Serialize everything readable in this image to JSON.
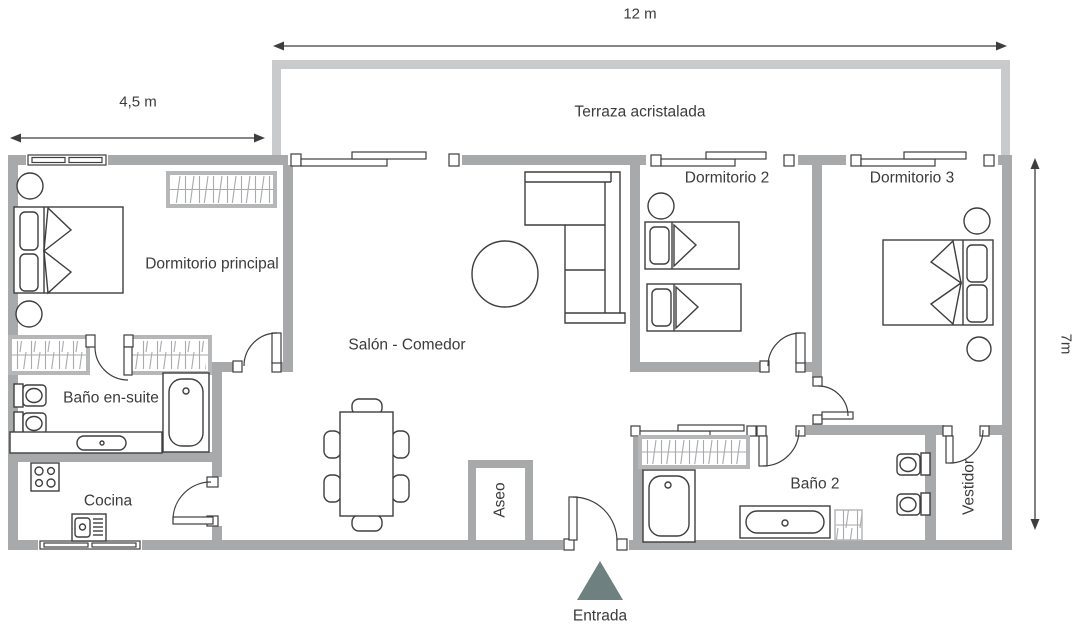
{
  "dimensions": {
    "top": "12 m",
    "left": "4,5 m",
    "right": "7m"
  },
  "rooms": {
    "terrace": "Terraza acristalada",
    "master_bedroom": "Dormitorio principal",
    "bedroom_2": "Dormitorio 2",
    "bedroom_3": "Dormitorio 3",
    "living_dining": "Salón - Comedor",
    "ensuite_bathroom": "Baño en-suite",
    "kitchen": "Cocina",
    "toilet": "Aseo",
    "bathroom_2": "Baño 2",
    "dressing_room": "Vestidor"
  },
  "entrance_label": "Entrada",
  "colors": {
    "wall": "#a7a9aa",
    "terrace_wall": "#c8cacb",
    "line": "#3e3e3e",
    "text": "#3b3b3b",
    "entrance_arrow": "#6f8081"
  }
}
